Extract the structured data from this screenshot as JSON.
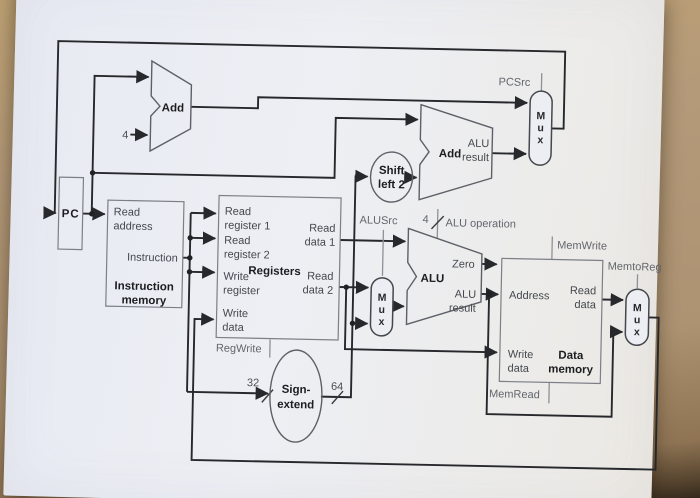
{
  "colors": {
    "desk": "#b49a79",
    "paper": "#edeff4",
    "wire": "#26282c",
    "box_stroke": "#7c7f86",
    "control_text": "#63666c"
  },
  "pc": {
    "label": "PC"
  },
  "adder_pc": {
    "label": "Add",
    "increment": "4"
  },
  "adder_branch": {
    "label": "Add",
    "result": [
      "ALU",
      "result"
    ]
  },
  "instruction_memory": {
    "read_address": [
      "Read",
      "address"
    ],
    "instruction": "Instruction",
    "title": [
      "Instruction",
      "memory"
    ]
  },
  "registers": {
    "title": "Registers",
    "read_register_1": [
      "Read",
      "register 1"
    ],
    "read_register_2": [
      "Read",
      "register 2"
    ],
    "write_register": [
      "Write",
      "register"
    ],
    "write_data": [
      "Write",
      "data"
    ],
    "read_data_1": [
      "Read",
      "data 1"
    ],
    "read_data_2": [
      "Read",
      "data 2"
    ]
  },
  "alu": {
    "label": "ALU",
    "zero": "Zero",
    "result": [
      "ALU",
      "result"
    ]
  },
  "shift_left_2": {
    "label": [
      "Shift",
      "left 2"
    ]
  },
  "sign_extend": {
    "label": [
      "Sign-",
      "extend"
    ],
    "input_width": "32",
    "output_width": "64"
  },
  "data_memory": {
    "title": [
      "Data",
      "memory"
    ],
    "address": "Address",
    "read_data": [
      "Read",
      "data"
    ],
    "write_data": [
      "Write",
      "data"
    ]
  },
  "mux": {
    "letters": [
      "M",
      "u",
      "x"
    ]
  },
  "signals": {
    "pcsrc": "PCSrc",
    "alusrc": "ALUSrc",
    "alu_operation": "ALU operation",
    "alu_operation_width": "4",
    "memwrite": "MemWrite",
    "memtoreg": "MemtoReg",
    "regwrite": "RegWrite",
    "memread": "MemRead"
  }
}
